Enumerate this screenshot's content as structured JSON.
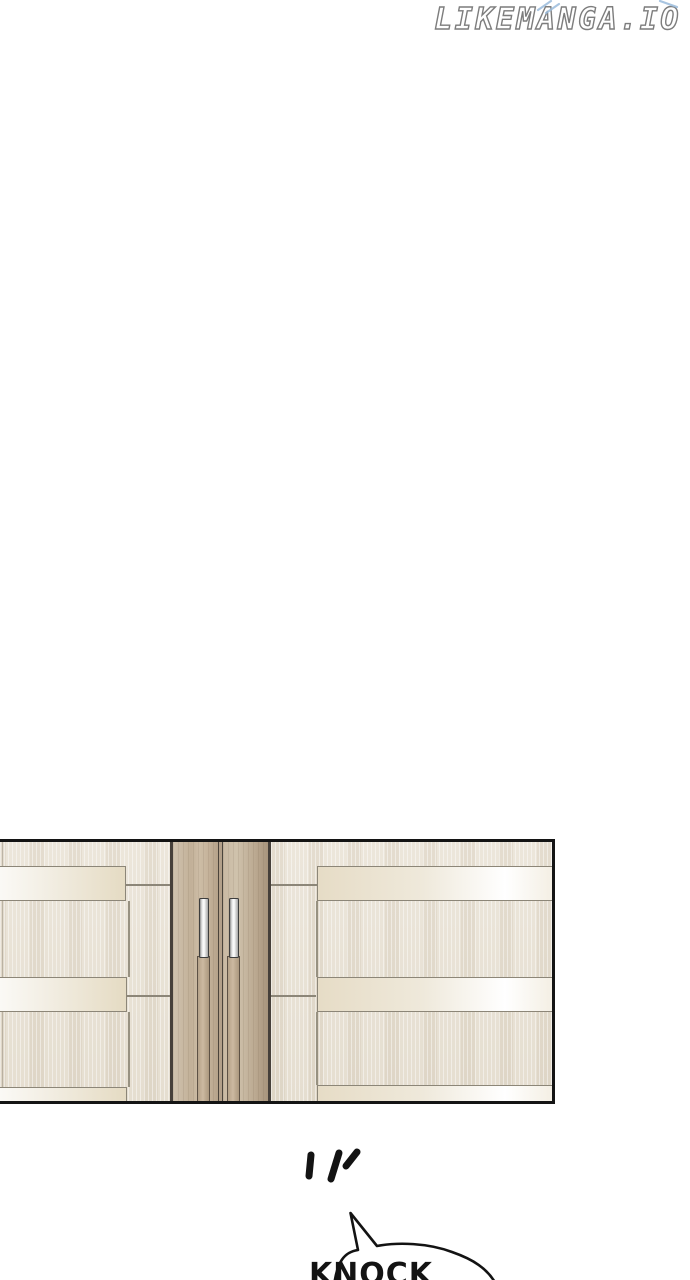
{
  "watermark": {
    "text": "LIKEMANGA.IO"
  },
  "sfx": {
    "bubble_text": "KNOCK"
  },
  "colors": {
    "ink": "#131313",
    "bubble_fill": "#ffffff",
    "sparkle_blue": "#9bbcdc",
    "watermark_outline": "#7d7d7d",
    "panel_border": "#141414",
    "wall": "#e9e3d6",
    "trim_line": "#8c8678",
    "door_wood": "#c2b098",
    "door_frame": "#46403a",
    "handle_silver": "#f0f0f0"
  }
}
